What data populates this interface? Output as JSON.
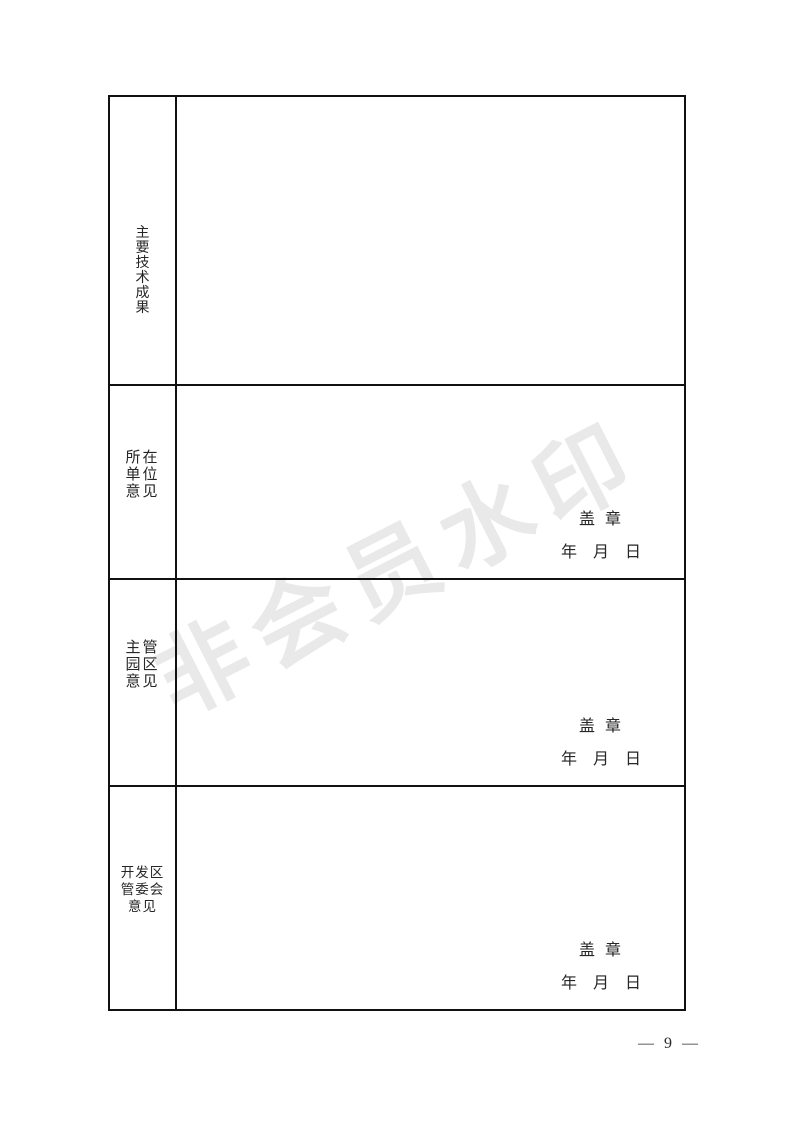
{
  "watermark": {
    "text": "非会员水印",
    "color": "#e9e9e9"
  },
  "form": {
    "rows": [
      {
        "label": "主要技术成果",
        "label_chars": [
          "主",
          "要",
          "技",
          "术",
          "成",
          "果"
        ]
      },
      {
        "label": "所在单位意见",
        "label_lines": [
          "所在",
          "单位",
          "意见"
        ],
        "stamp_label": "盖 章",
        "date_label": "年 月 日"
      },
      {
        "label": "主管园区意见",
        "label_lines": [
          "主管",
          "园区",
          "意见"
        ],
        "stamp_label": "盖 章",
        "date_label": "年 月 日"
      },
      {
        "label": "开发区管委会意见",
        "label_lines": [
          "开发区",
          "管委会",
          "意见"
        ],
        "stamp_label": "盖 章",
        "date_label": "年 月 日"
      }
    ]
  },
  "footer": {
    "page_number": "— 9 —"
  },
  "colors": {
    "border": "#111111",
    "text": "#262626",
    "watermark": "#e9e9e9"
  }
}
